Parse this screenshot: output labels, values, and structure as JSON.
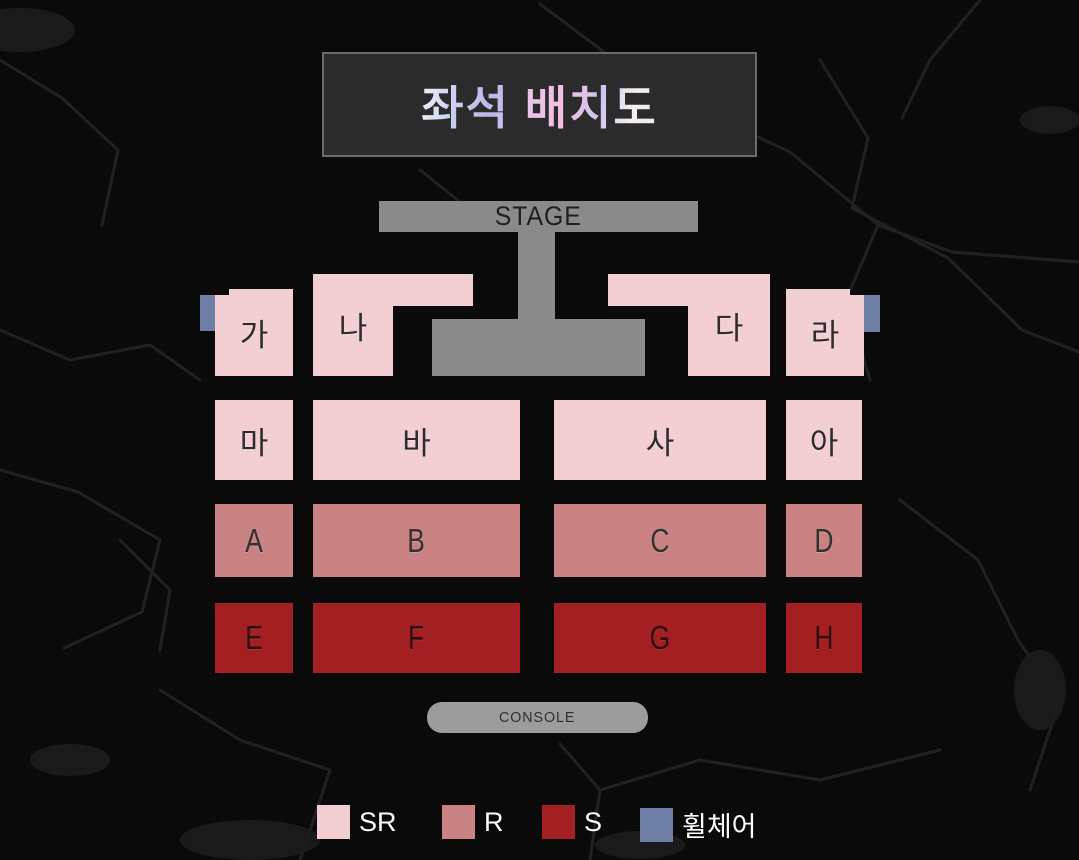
{
  "title": {
    "text": "좌석 배치도"
  },
  "stage": {
    "label": "STAGE"
  },
  "console": {
    "label": "CONSOLE"
  },
  "colors": {
    "sr": "#f3ced3",
    "r": "#ca8282",
    "s": "#a41f21",
    "wheelchair": "#6f7ea4",
    "stage_gray": "#8a8a8a",
    "console_gray": "#9c9c9c",
    "background": "#0a0a0a"
  },
  "sections": {
    "row1": [
      {
        "id": "ga",
        "label": "가",
        "tier": "SR"
      },
      {
        "id": "na",
        "label": "나",
        "tier": "SR"
      },
      {
        "id": "da",
        "label": "다",
        "tier": "SR"
      },
      {
        "id": "ra",
        "label": "라",
        "tier": "SR"
      }
    ],
    "row2": [
      {
        "id": "ma",
        "label": "마",
        "tier": "SR"
      },
      {
        "id": "ba",
        "label": "바",
        "tier": "SR"
      },
      {
        "id": "sa",
        "label": "사",
        "tier": "SR"
      },
      {
        "id": "ah",
        "label": "아",
        "tier": "SR"
      }
    ],
    "row3": [
      {
        "id": "A",
        "label": "A",
        "tier": "R"
      },
      {
        "id": "B",
        "label": "B",
        "tier": "R"
      },
      {
        "id": "C",
        "label": "C",
        "tier": "R"
      },
      {
        "id": "D",
        "label": "D",
        "tier": "R"
      }
    ],
    "row4": [
      {
        "id": "E",
        "label": "E",
        "tier": "S"
      },
      {
        "id": "F",
        "label": "F",
        "tier": "S"
      },
      {
        "id": "G",
        "label": "G",
        "tier": "S"
      },
      {
        "id": "H",
        "label": "H",
        "tier": "S"
      }
    ]
  },
  "wheelchair_seats": [
    {
      "side": "left",
      "tier": "휠체어"
    },
    {
      "side": "right",
      "tier": "휠체어"
    }
  ],
  "legend": [
    {
      "label": "SR",
      "color": "#f3ced3"
    },
    {
      "label": "R",
      "color": "#ca8282"
    },
    {
      "label": "S",
      "color": "#a41f21"
    },
    {
      "label": "휠체어",
      "color": "#6f7ea4"
    }
  ]
}
